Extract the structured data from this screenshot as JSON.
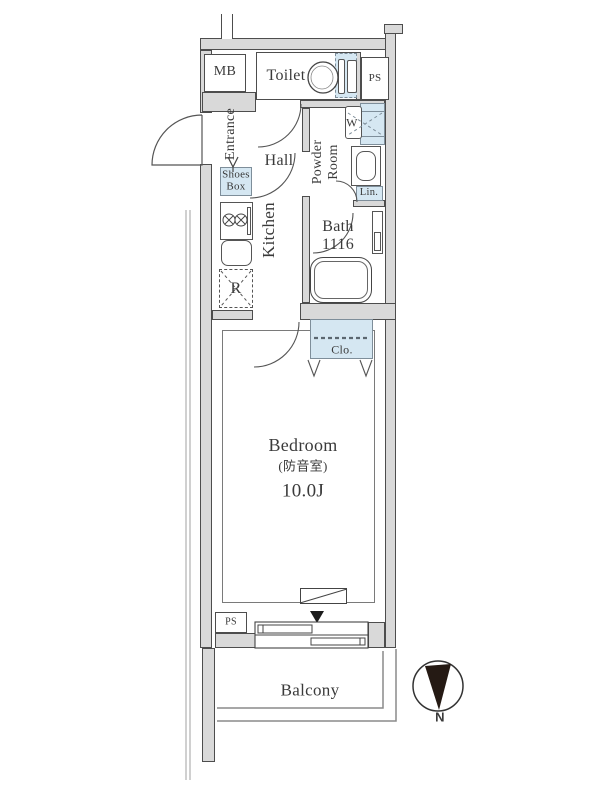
{
  "title": "apartment-floor-plan",
  "labels": {
    "mb": "MB",
    "toilet": "Toilet",
    "ps_top": "PS",
    "entrance": "Entrance",
    "shoes_box": "Shoes\nBox",
    "hall": "Hall",
    "powder_room": "Powder\nRoom",
    "washer": "W",
    "linen": "Lin.",
    "kitchen": "Kitchen",
    "refrigerator": "R",
    "bath": "Bath\n1116",
    "closet": "Clo.",
    "bedroom_name": "Bedroom",
    "bedroom_note": "(防音室)",
    "bedroom_size": "10.0J",
    "ps_bottom": "PS",
    "balcony": "Balcony",
    "compass_north": "N"
  },
  "colors": {
    "wall_fill": "#d9d9d9",
    "wall_line": "#4d4d4d",
    "fixture_blue": "#d5e7f2",
    "fixture_blue_border": "#7e8e9a",
    "line": "#555555",
    "text": "#3a3a3a"
  }
}
